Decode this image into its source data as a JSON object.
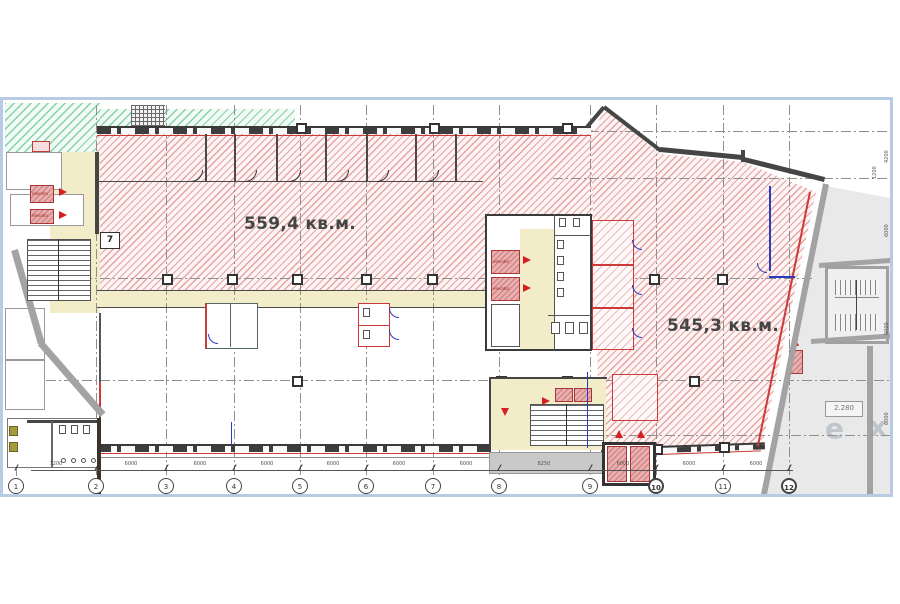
{
  "plan": {
    "areas": {
      "left": "559,4 кв.м.",
      "right": "545,3 кв.м."
    },
    "elevation_mark": "2.280",
    "elevator_label": "elevator",
    "room_number": "7",
    "watermark": {
      "l1": "e",
      "l2": "x"
    },
    "grid_bubbles": [
      {
        "n": "1"
      },
      {
        "n": "2"
      },
      {
        "n": "3"
      },
      {
        "n": "4"
      },
      {
        "n": "5"
      },
      {
        "n": "6"
      },
      {
        "n": "7"
      },
      {
        "n": "8"
      },
      {
        "n": "9"
      },
      {
        "n": "10"
      },
      {
        "n": "11"
      },
      {
        "n": "12"
      }
    ],
    "dims_bottom": [
      "7200",
      "6000",
      "6000",
      "6000",
      "6000",
      "6000",
      "6000",
      "8250",
      "6000",
      "6000",
      "6000"
    ],
    "dims_right": [
      "4200",
      "1200",
      "6000",
      "6000",
      "6000"
    ],
    "colors": {
      "hatch_red": "#e7a4a4",
      "hatch_green": "#84d1a7",
      "corridor_yellow": "#f3ecc9",
      "elevator_pink": "#e9aeae",
      "frame_blue": "#b7cbe5",
      "arrow_red": "#d42020",
      "neighbor_gray": "#e9e9e9"
    }
  }
}
